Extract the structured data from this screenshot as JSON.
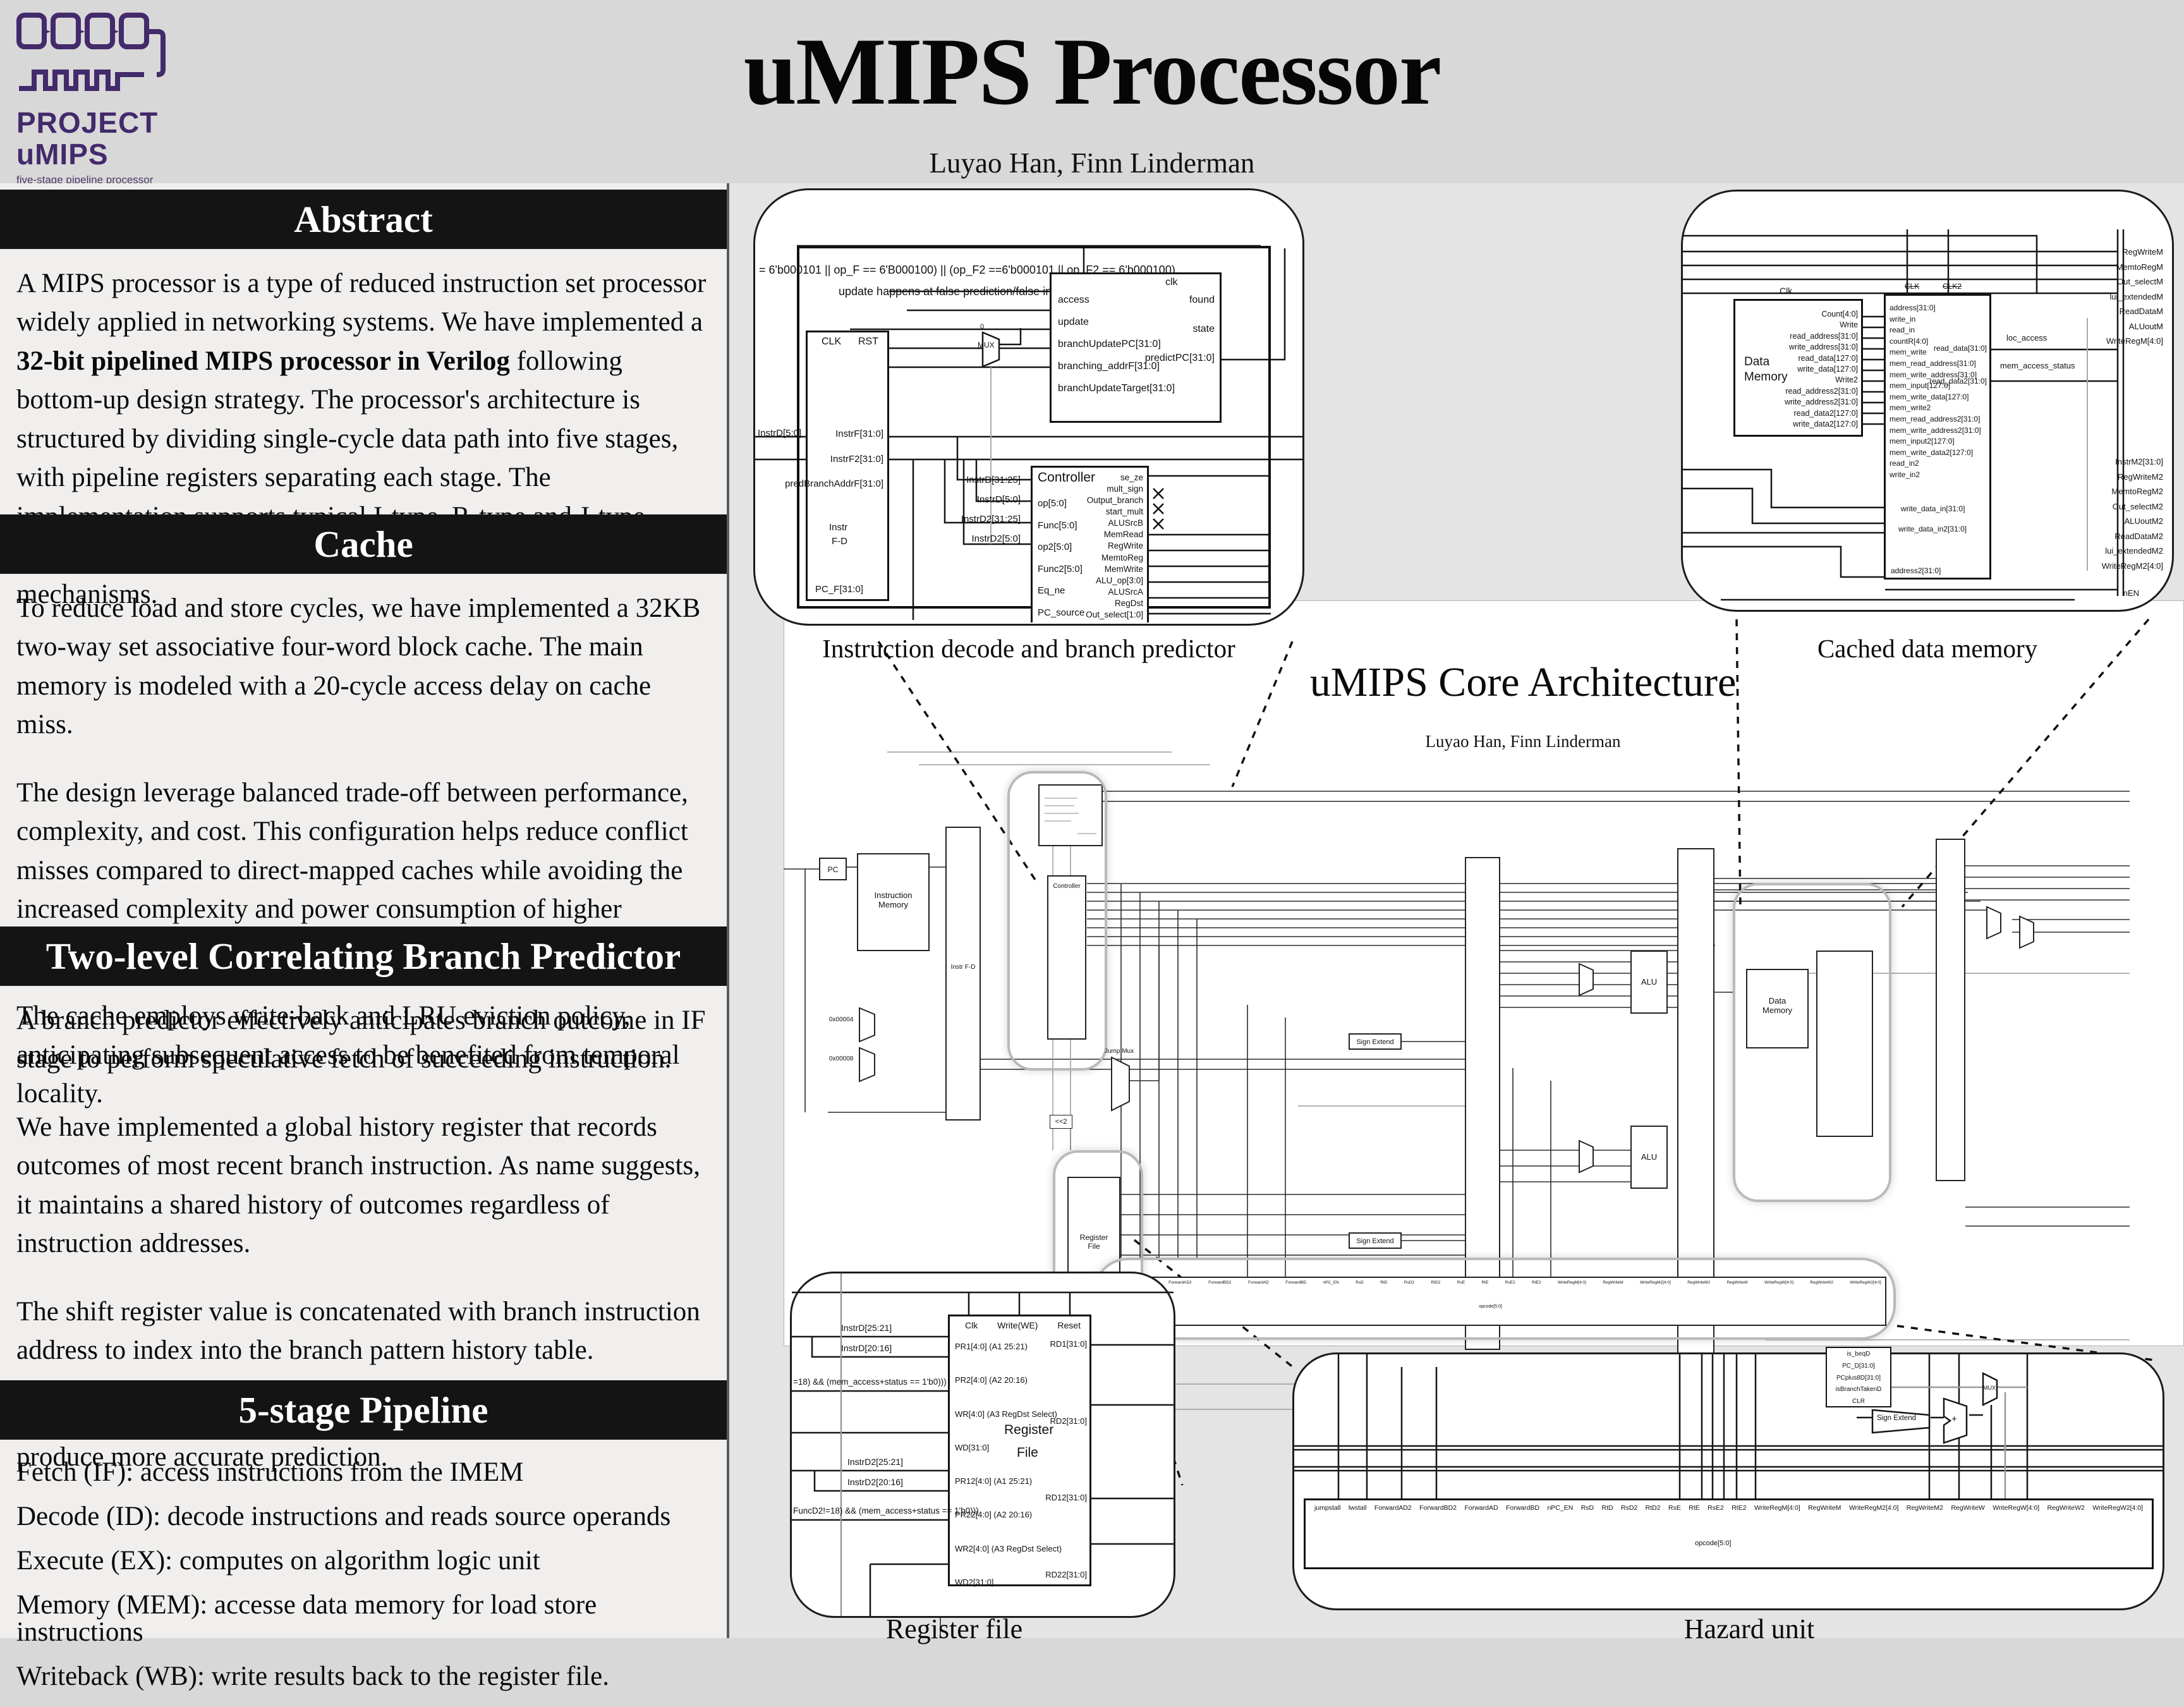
{
  "header": {
    "title": "uMIPS Processor",
    "authors": "Luyao Han, Finn Linderman"
  },
  "logo": {
    "line1": "PROJECT",
    "line2": "uMIPS",
    "tagline": "five-stage pipeline processor"
  },
  "sidebar": {
    "abstract": {
      "title": "Abstract",
      "p_pre": "A MIPS processor is a type of reduced instruction set processor widely applied in networking systems. We have implemented a ",
      "p_bold": "32-bit pipelined MIPS processor in Verilog",
      "p_post": " following bottom-up design strategy. The processor's architecture is structured by dividing single-cycle data path into five stages, with pipeline registers separating each stage. The implementation supports typical I-type, R-type and J-type instructions and handles data hazards through pipeline control mechanisms."
    },
    "cache": {
      "title": "Cache",
      "paragraphs": [
        "To reduce load and store cycles, we have implemented a 32KB two-way set associative four-word block cache. The main memory is modeled with a 20-cycle access delay on cache miss.",
        "The design leverage balanced trade-off between performance, complexity, and cost. This configuration helps reduce conflict misses compared to direct-mapped caches while avoiding the increased complexity and power consumption of higher associativity levels.",
        "The cache employs write-back and LRU eviction policy, anticipating subsequent access to be benefited from temporal locality."
      ]
    },
    "branch_predictor": {
      "title": "Two-level Correlating Branch Predictor",
      "paragraphs": [
        "A branch predictor effectively anticipates branch outcome in IF stage to perform speculative fetch of succeeding instruction.",
        "We have implemented a global history register that records outcomes of most recent branch instruction. As name suggests, it maintains a shared history of outcomes regardless of instruction addresses.",
        "The shift register value is concatenated with branch instruction address to index into the branch pattern history table.",
        "The design allows processor to leverage past branch result to produce more accurate prediction."
      ]
    },
    "pipeline": {
      "title": "5-stage Pipeline",
      "lines": [
        "Fetch (IF): access instructions from the IMEM",
        "Decode (ID): decode instructions and reads source operands",
        "Execute (EX): computes on algorithm logic unit",
        "Memory (MEM): accesse data memory for load store instructions",
        "Writeback (WB): write results back to the register file."
      ]
    }
  },
  "core": {
    "title": "uMIPS Core Architecture",
    "subtitle": "Luyao Han, Finn Linderman",
    "blocks": {
      "pc": "PC",
      "imem1": "Instruction",
      "imem2": "Memory",
      "fd": "Instr F-D",
      "controller": "Controller",
      "regfile1": "Register",
      "regfile2": "File",
      "alu": "ALU",
      "dmem1": "Data",
      "dmem2": "Memory",
      "sign_extend": "Sign Extend",
      "shift": "<<2",
      "jumpmux": "Jump Mux",
      "const1": "0x00004",
      "const2": "0x00008"
    }
  },
  "decode_callout": {
    "caption": "Instruction decode and branch predictor",
    "annotation1": "= 6'b000101 || op_F == 6'B000100) || (op_F2 ==6'b000101 || op_F2 == 6'b000100)",
    "annotation2": "update happens at false prediction/false increment",
    "predictor": {
      "clk": "clk",
      "inputs": [
        "access",
        "update",
        "branchUpdatePC[31:0]",
        "branching_addrF[31:0]",
        "branchUpdateTarget[31:0]"
      ],
      "outputs": [
        "found",
        "state",
        "predictPC[31:0]"
      ]
    },
    "mux": "MUX",
    "mux_zero": "0",
    "fd_register": {
      "clk": "CLK",
      "rst": "RST",
      "left_label": "InstrD[5:0]",
      "signals": [
        "InstrF[31:0]",
        "InstrF2[31:0]",
        "predBranchAddrF[31:0]"
      ],
      "name1": "Instr",
      "name2": "F-D",
      "bottom": "PC_F[31:0]"
    },
    "controller": {
      "title": "Controller",
      "inputs": [
        "op[5:0]",
        "Func[5:0]",
        "op2[5:0]",
        "Func2[5:0]",
        "Eq_ne",
        "PC_source"
      ],
      "outputs": [
        "se_ze",
        "mult_sign",
        "Output_branch",
        "start_mult",
        "ALUSrcB",
        "MemRead",
        "RegWrite",
        "MemtoReg",
        "MemWrite",
        "ALU_op[3:0]",
        "ALUSrcA",
        "RegDst",
        "Out_select[1:0]"
      ],
      "wire_labels": [
        "InstrD[31:25]",
        "InstrD[5:0]",
        "InstrD2[31:25]",
        "InstrD2[5:0]"
      ]
    }
  },
  "memory_callout": {
    "caption": "Cached data memory",
    "data_memory": {
      "title1": "Data",
      "title2": "Memory",
      "clk": "Clk",
      "ports": [
        "Count[4:0]",
        "Write",
        "read_address[31:0]",
        "write_address[31:0]",
        "read_data[127:0]",
        "write_data[127:0]",
        "Write2",
        "read_address2[31:0]",
        "write_address2[31:0]",
        "read_data2[127:0]",
        "write_data2[127:0]"
      ]
    },
    "cache": {
      "clk": "CLK",
      "clk2": "CLK2",
      "left_ports": [
        "address[31:0]",
        "write_in",
        "read_in",
        "countR[4:0]",
        "mem_write",
        "mem_read_address[31:0]",
        "mem_write_address[31:0]",
        "mem_input[127:0]",
        "mem_write_data[127:0]",
        "mem_write2",
        "mem_read_address2[31:0]",
        "mem_write_address2[31:0]",
        "mem_input2[127:0]",
        "mem_write_data2[127:0]",
        "read_in2",
        "write_in2"
      ],
      "write_data_in": "write_data_in[31:0]",
      "write_data_in2": "write_data_in2[31:0]",
      "address2": "address2[31:0]",
      "out1": "read_data[31:0]",
      "out2": "read_data2[31:0]",
      "status1": "loc_access",
      "status2": "mem_access_status"
    },
    "bus_top": [
      "RegWriteM",
      "MemtoRegM",
      "Out_selectM",
      "lui_extendedM",
      "ReadDataM",
      "ALUoutM",
      "WriteRegM[4:0]"
    ],
    "bus_bottom": [
      "InstrM2[31:0]",
      "RegWriteM2",
      "MemtoRegM2",
      "Out_selectM2",
      "ALUoutM2",
      "ReadDataM2",
      "lui_extendedM2",
      "WriteRegM2[4:0]"
    ],
    "nen": "nEN"
  },
  "regfile_callout": {
    "caption": "Register file",
    "block": {
      "title1": "Register",
      "title2": "File",
      "top": [
        "Clk",
        "Write(WE)",
        "Reset"
      ],
      "left_ports": [
        "PR1[4:0] (A1 25:21)",
        "PR2[4:0] (A2 20:16)",
        "WR[4:0] (A3 RegDst Select)",
        "WD[31:0]",
        "PR12[4:0] (A1 25:21)",
        "PR22[4:0] (A2 20:16)",
        "WR2[4:0] (A3 RegDst Select)",
        "WD2[31:0]"
      ],
      "right_ports": [
        "RD1[31:0]",
        "RD2[31:0]",
        "RD12[31:0]",
        "RD22[31:0]"
      ]
    },
    "wire_labels": {
      "a": "InstrD[25:21]",
      "b": "InstrD[20:16]",
      "c": "=18) && (mem_access+status == 1'b0)))",
      "d": "InstrD2[25:21]",
      "e": "InstrD2[20:16]",
      "f": "FuncD2!=18) && (mem_access+status == 1'b0)))"
    }
  },
  "hazard_callout": {
    "caption": "Hazard unit",
    "top_labels": [
      "jumpstall",
      "lwstall",
      "ForwardAD2",
      "ForwardBD2",
      "ForwardAD",
      "ForwardBD",
      "nPC_EN",
      "RsD",
      "RtD",
      "RsD2",
      "RtD2",
      "RsE",
      "RtE",
      "RsE2",
      "RtE2",
      "WriteRegM[4:0]",
      "RegWriteM",
      "WriteRegM2[4:0]",
      "RegWriteM2",
      "RegWriteW",
      "WriteRegW[4:0]",
      "RegWriteW2",
      "WriteRegW2[4:0]"
    ],
    "opcode": "opcode[5:0]",
    "pc_block": [
      "is_beqD",
      "PC_D[31:0]",
      "PCplus8D[31:0]",
      "isBranchTakenD",
      "CLR"
    ],
    "sign_extend": "Sign Extend",
    "mux": "MUX",
    "plus": "+"
  },
  "colors": {
    "logo_purple": "#432a6b",
    "header_bar": "#141414",
    "page_bg": "#d8d8d8",
    "sidebar_bg": "#f1efee",
    "diagram_bg": "#e4e4e4",
    "canvas": "#ffffff"
  }
}
